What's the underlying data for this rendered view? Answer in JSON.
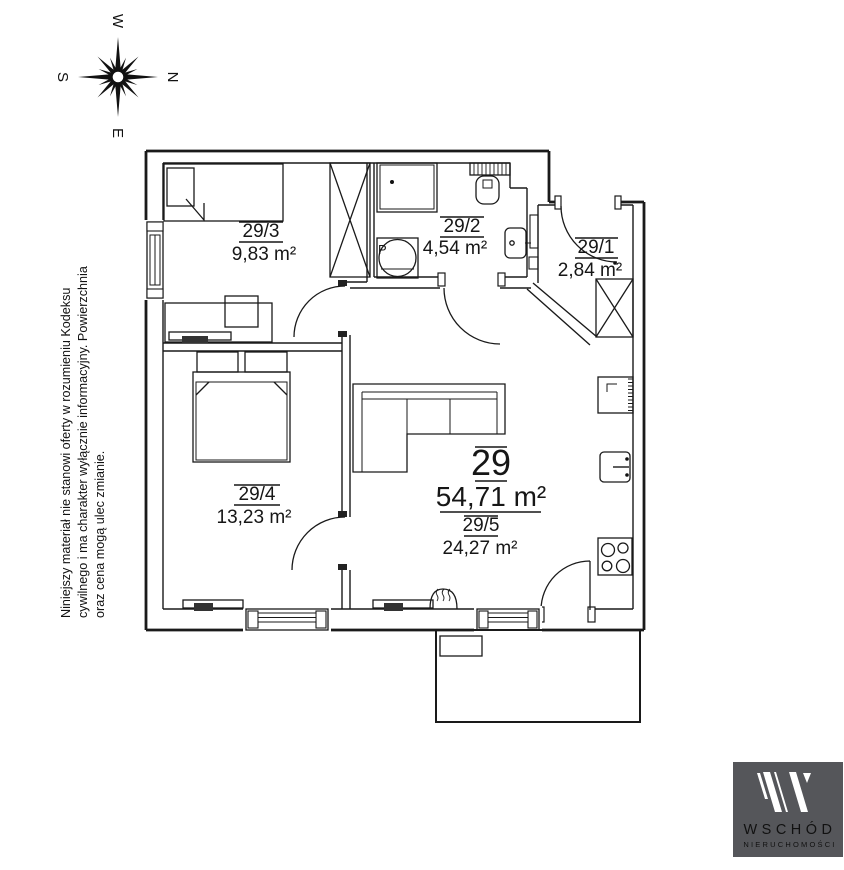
{
  "compass": {
    "top": "W",
    "right": "N",
    "bottom": "E",
    "left": "S"
  },
  "disclaimer": {
    "line1": "Niniejszy materiał nie stanowi oferty w rozumieniu Kodeksu",
    "line2": "cywilnego i ma charakter wyłącznie informacyjny. Powierzchnia",
    "line3": "oraz cena mogą ulec zmianie."
  },
  "unit": {
    "number": "29",
    "total_area": "54,71 m²"
  },
  "rooms": [
    {
      "id": "29/1",
      "area": "2,84 m²"
    },
    {
      "id": "29/2",
      "area": "4,54 m²"
    },
    {
      "id": "29/3",
      "area": "9,83 m²"
    },
    {
      "id": "29/4",
      "area": "13,23 m²"
    },
    {
      "id": "29/5",
      "area": "24,27 m²"
    }
  ],
  "symbols": {
    "washer_label": "P"
  },
  "colors": {
    "line": "#1a1a1a",
    "logo_bg": "#55565a",
    "logo_subtitle": "#a9abae"
  },
  "logo": {
    "brand": "WSCHÓD",
    "subtitle": "NIERUCHOMOŚCI"
  }
}
